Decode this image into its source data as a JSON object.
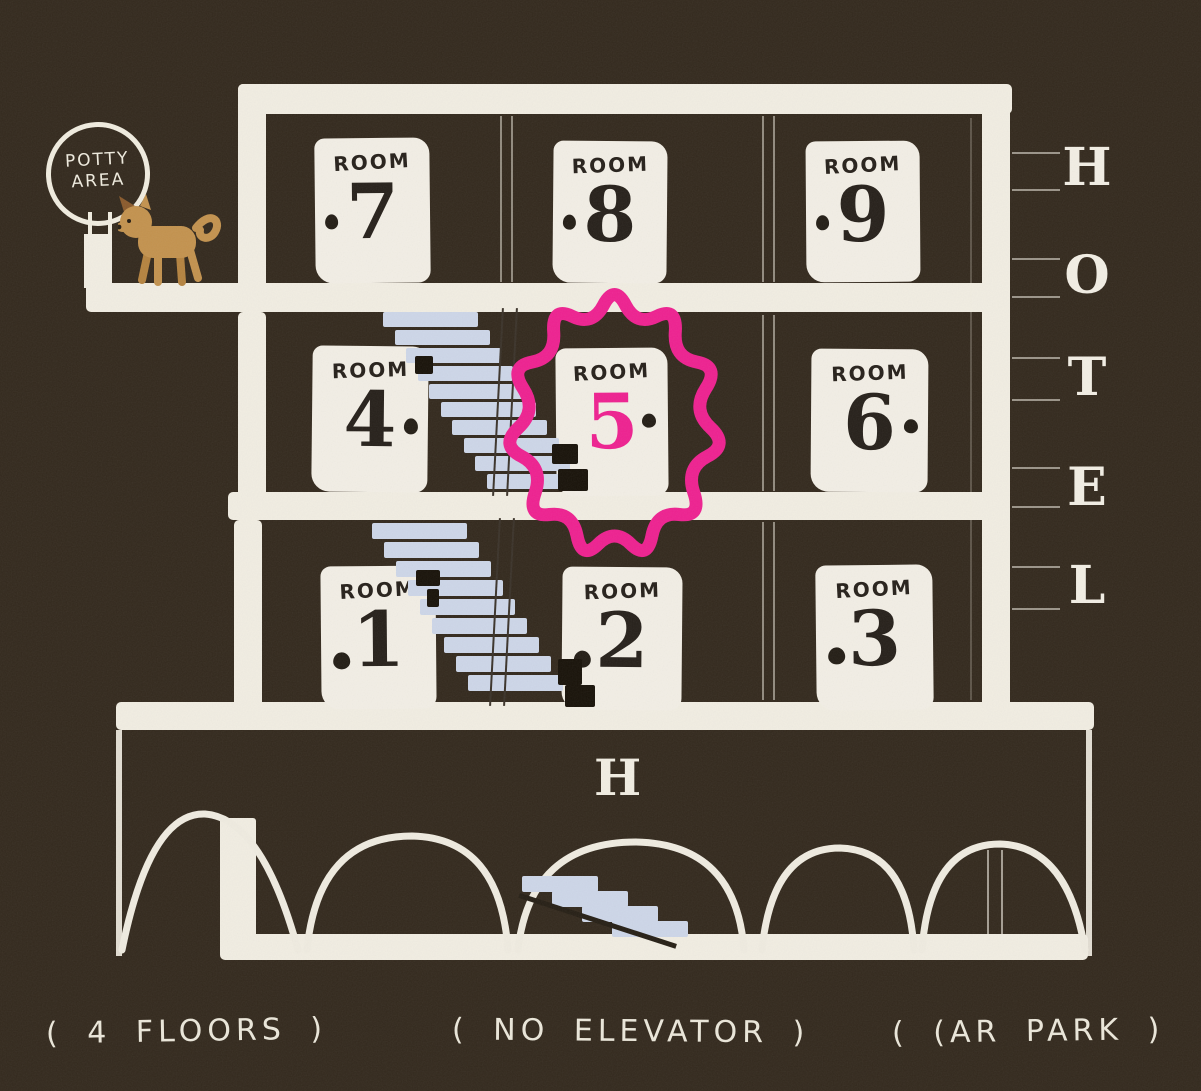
{
  "colors": {
    "background": "#33291d",
    "ink_white": "#f1ede2",
    "stair_blue": "#cdd6e8",
    "highlight_pink": "#ee2190",
    "door_ink": "#26201a",
    "dog_tan": "#c3924e"
  },
  "potty_sign": {
    "line1": "POTTY",
    "line2": "AREA"
  },
  "rooms": {
    "r7": {
      "label": "ROOM",
      "number": "7"
    },
    "r8": {
      "label": "ROOM",
      "number": "8"
    },
    "r9": {
      "label": "ROOM",
      "number": "9"
    },
    "r4": {
      "label": "ROOM",
      "number": "4"
    },
    "r5": {
      "label": "ROOM",
      "number": "5"
    },
    "r6": {
      "label": "ROOM",
      "number": "6"
    },
    "r1": {
      "label": "ROOM",
      "number": "1"
    },
    "r2": {
      "label": "ROOM",
      "number": "2"
    },
    "r3": {
      "label": "ROOM",
      "number": "3"
    }
  },
  "highlight": {
    "room": "5"
  },
  "hotel_sign": {
    "letters": [
      "H",
      "O",
      "T",
      "E",
      "L"
    ]
  },
  "ground_floor": {
    "letter": "H"
  },
  "captions": {
    "floors": "( 4  FLOORS )",
    "elevator": "( NO  ELEVATOR )",
    "car_park": "( (AR  PARK )"
  }
}
